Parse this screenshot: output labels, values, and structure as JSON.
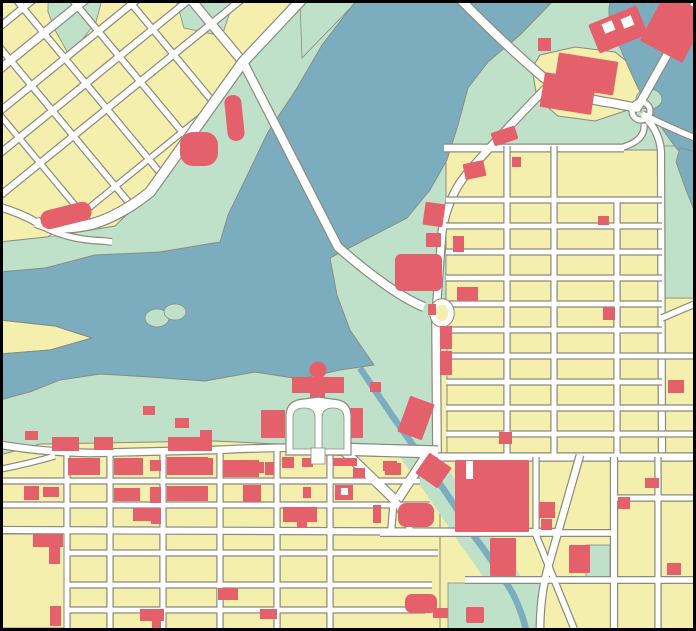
{
  "map": {
    "title": "city-map-with-lake-and-street-grids",
    "colors": {
      "park": "#bfe1ca",
      "water": "#7badbf",
      "blocks": "#f5efad",
      "building": "#e4616b",
      "road_fill": "#ffffff",
      "road_casing": "#8a8a7d",
      "frame": "#000000"
    },
    "features": {
      "water_bodies": [
        "lake",
        "river",
        "meander-channel",
        "creek-canal"
      ],
      "districts": [
        "diagonal-grid-northwest",
        "regular-grid-east",
        "regular-grid-south",
        "riverside-d-block"
      ],
      "landmarks": [
        "legislative-building",
        "horseshoe-drive",
        "highway-roundabout",
        "triangle-junction",
        "big-mall-building",
        "lake-island",
        "yellow-peninsula"
      ]
    },
    "islands": {
      "lake": [
        {
          "cx": 157,
          "cy": 318,
          "rx": 12,
          "ry": 9
        },
        {
          "cx": 175,
          "cy": 312,
          "rx": 11,
          "ry": 8
        }
      ],
      "channel": [
        {
          "cx": 662,
          "cy": 38,
          "rx": 16,
          "ry": 11,
          "rot": 30
        },
        {
          "cx": 649,
          "cy": 99,
          "rx": 13,
          "ry": 10,
          "rot": 0
        }
      ]
    },
    "legislature": {
      "dome": {
        "cx": 318,
        "cy": 370,
        "r": 8.5
      },
      "bar": [
        292,
        377,
        52,
        16
      ],
      "stem": [
        310,
        391,
        15,
        11
      ]
    },
    "buildings": [
      [
        40,
        206,
        52,
        19,
        -14,
        9
      ],
      [
        180,
        132,
        38,
        34,
        0,
        13
      ],
      [
        226,
        95,
        17,
        46,
        -6,
        8
      ],
      [
        592,
        14,
        52,
        31,
        -22,
        2
      ],
      [
        603,
        22,
        11,
        10,
        -22,
        0,
        "hole"
      ],
      [
        622,
        17,
        11,
        10,
        -22,
        0,
        "hole"
      ],
      [
        538,
        38,
        13,
        13,
        0,
        0
      ],
      [
        650,
        0,
        48,
        55,
        28,
        2
      ],
      [
        556,
        57,
        60,
        34,
        9,
        1
      ],
      [
        542,
        76,
        52,
        35,
        9,
        1
      ],
      [
        492,
        129,
        25,
        14,
        -18,
        2
      ],
      [
        424,
        203,
        20,
        23,
        8,
        1
      ],
      [
        426,
        233,
        15,
        14,
        0,
        1
      ],
      [
        395,
        254,
        47,
        37,
        0,
        6
      ],
      [
        440,
        326,
        12,
        23,
        0,
        0
      ],
      [
        440,
        351,
        12,
        24,
        0,
        0
      ],
      [
        428,
        304,
        8,
        11,
        0,
        0
      ],
      [
        370,
        382,
        11,
        10,
        0,
        0
      ],
      [
        403,
        399,
        26,
        38,
        20,
        1
      ],
      [
        261,
        410,
        24,
        28,
        0,
        1
      ],
      [
        346,
        408,
        17,
        30,
        0,
        1
      ],
      [
        420,
        458,
        27,
        25,
        35,
        1
      ],
      [
        143,
        406,
        12,
        9,
        0,
        0
      ],
      [
        175,
        418,
        14,
        10,
        0,
        0
      ],
      [
        200,
        430,
        12,
        9,
        0,
        0
      ],
      [
        25,
        431,
        13,
        9,
        0,
        0
      ],
      [
        464,
        162,
        21,
        16,
        -12,
        1
      ],
      [
        512,
        157,
        9,
        10,
        0,
        0
      ],
      [
        453,
        236,
        11,
        16,
        0,
        0
      ],
      [
        457,
        287,
        21,
        14,
        0,
        0
      ],
      [
        598,
        216,
        11,
        9,
        0,
        0
      ],
      [
        603,
        307,
        12,
        13,
        0,
        0
      ],
      [
        499,
        432,
        13,
        12,
        0,
        0
      ],
      [
        668,
        380,
        16,
        13,
        0,
        0
      ],
      [
        52,
        437,
        27,
        14,
        0,
        0
      ],
      [
        94,
        437,
        19,
        13,
        0,
        0
      ],
      [
        168,
        437,
        44,
        14,
        0,
        0
      ],
      [
        68,
        458,
        32,
        17,
        0,
        0
      ],
      [
        114,
        458,
        29,
        17,
        0,
        0
      ],
      [
        150,
        460,
        11,
        11,
        0,
        0
      ],
      [
        167,
        457,
        41,
        18,
        0,
        0
      ],
      [
        200,
        458,
        13,
        17,
        0,
        0
      ],
      [
        223,
        460,
        36,
        17,
        0,
        0
      ],
      [
        258,
        462,
        6,
        11,
        0,
        0
      ],
      [
        265,
        462,
        9,
        13,
        0,
        0
      ],
      [
        282,
        457,
        12,
        11,
        0,
        0
      ],
      [
        302,
        458,
        11,
        9,
        0,
        0
      ],
      [
        333,
        458,
        24,
        8,
        0,
        0
      ],
      [
        353,
        468,
        12,
        10,
        0,
        0
      ],
      [
        24,
        486,
        15,
        14,
        0,
        0
      ],
      [
        43,
        487,
        16,
        10,
        0,
        0
      ],
      [
        114,
        488,
        26,
        13,
        0,
        0
      ],
      [
        150,
        487,
        11,
        16,
        0,
        0
      ],
      [
        167,
        486,
        41,
        15,
        0,
        0
      ],
      [
        243,
        485,
        18,
        17,
        0,
        0
      ],
      [
        303,
        487,
        8,
        11,
        0,
        0
      ],
      [
        335,
        485,
        18,
        15,
        0,
        0
      ],
      [
        341,
        488,
        7,
        7,
        0,
        0,
        "hole"
      ],
      [
        133,
        508,
        18,
        13,
        0,
        0
      ],
      [
        151,
        508,
        10,
        16,
        0,
        0
      ],
      [
        283,
        507,
        34,
        15,
        0,
        0
      ],
      [
        297,
        519,
        10,
        9,
        0,
        0
      ],
      [
        373,
        505,
        8,
        18,
        0,
        0
      ],
      [
        33,
        534,
        30,
        13,
        0,
        0
      ],
      [
        49,
        546,
        11,
        18,
        0,
        0
      ],
      [
        50,
        606,
        11,
        20,
        0,
        0
      ],
      [
        140,
        609,
        24,
        12,
        0,
        0
      ],
      [
        152,
        620,
        9,
        8,
        0,
        0
      ],
      [
        218,
        588,
        20,
        12,
        0,
        0
      ],
      [
        260,
        609,
        17,
        10,
        0,
        0
      ],
      [
        405,
        594,
        32,
        19,
        0,
        7
      ],
      [
        433,
        608,
        15,
        10,
        0,
        0
      ],
      [
        385,
        463,
        16,
        12,
        0,
        0
      ],
      [
        383,
        461,
        14,
        10,
        0,
        0
      ],
      [
        398,
        503,
        36,
        24,
        0,
        8
      ],
      [
        466,
        607,
        18,
        16,
        0,
        2
      ],
      [
        455,
        460,
        74,
        72,
        0,
        1
      ],
      [
        466,
        461,
        7,
        18,
        0,
        0,
        "hole"
      ],
      [
        539,
        502,
        16,
        16,
        0,
        0
      ],
      [
        541,
        519,
        11,
        11,
        0,
        0
      ],
      [
        618,
        497,
        12,
        12,
        0,
        0
      ],
      [
        645,
        478,
        14,
        10,
        0,
        0
      ],
      [
        569,
        545,
        21,
        28,
        0,
        1
      ],
      [
        490,
        538,
        26,
        38,
        0,
        1
      ],
      [
        667,
        563,
        14,
        12,
        0,
        0
      ]
    ]
  }
}
